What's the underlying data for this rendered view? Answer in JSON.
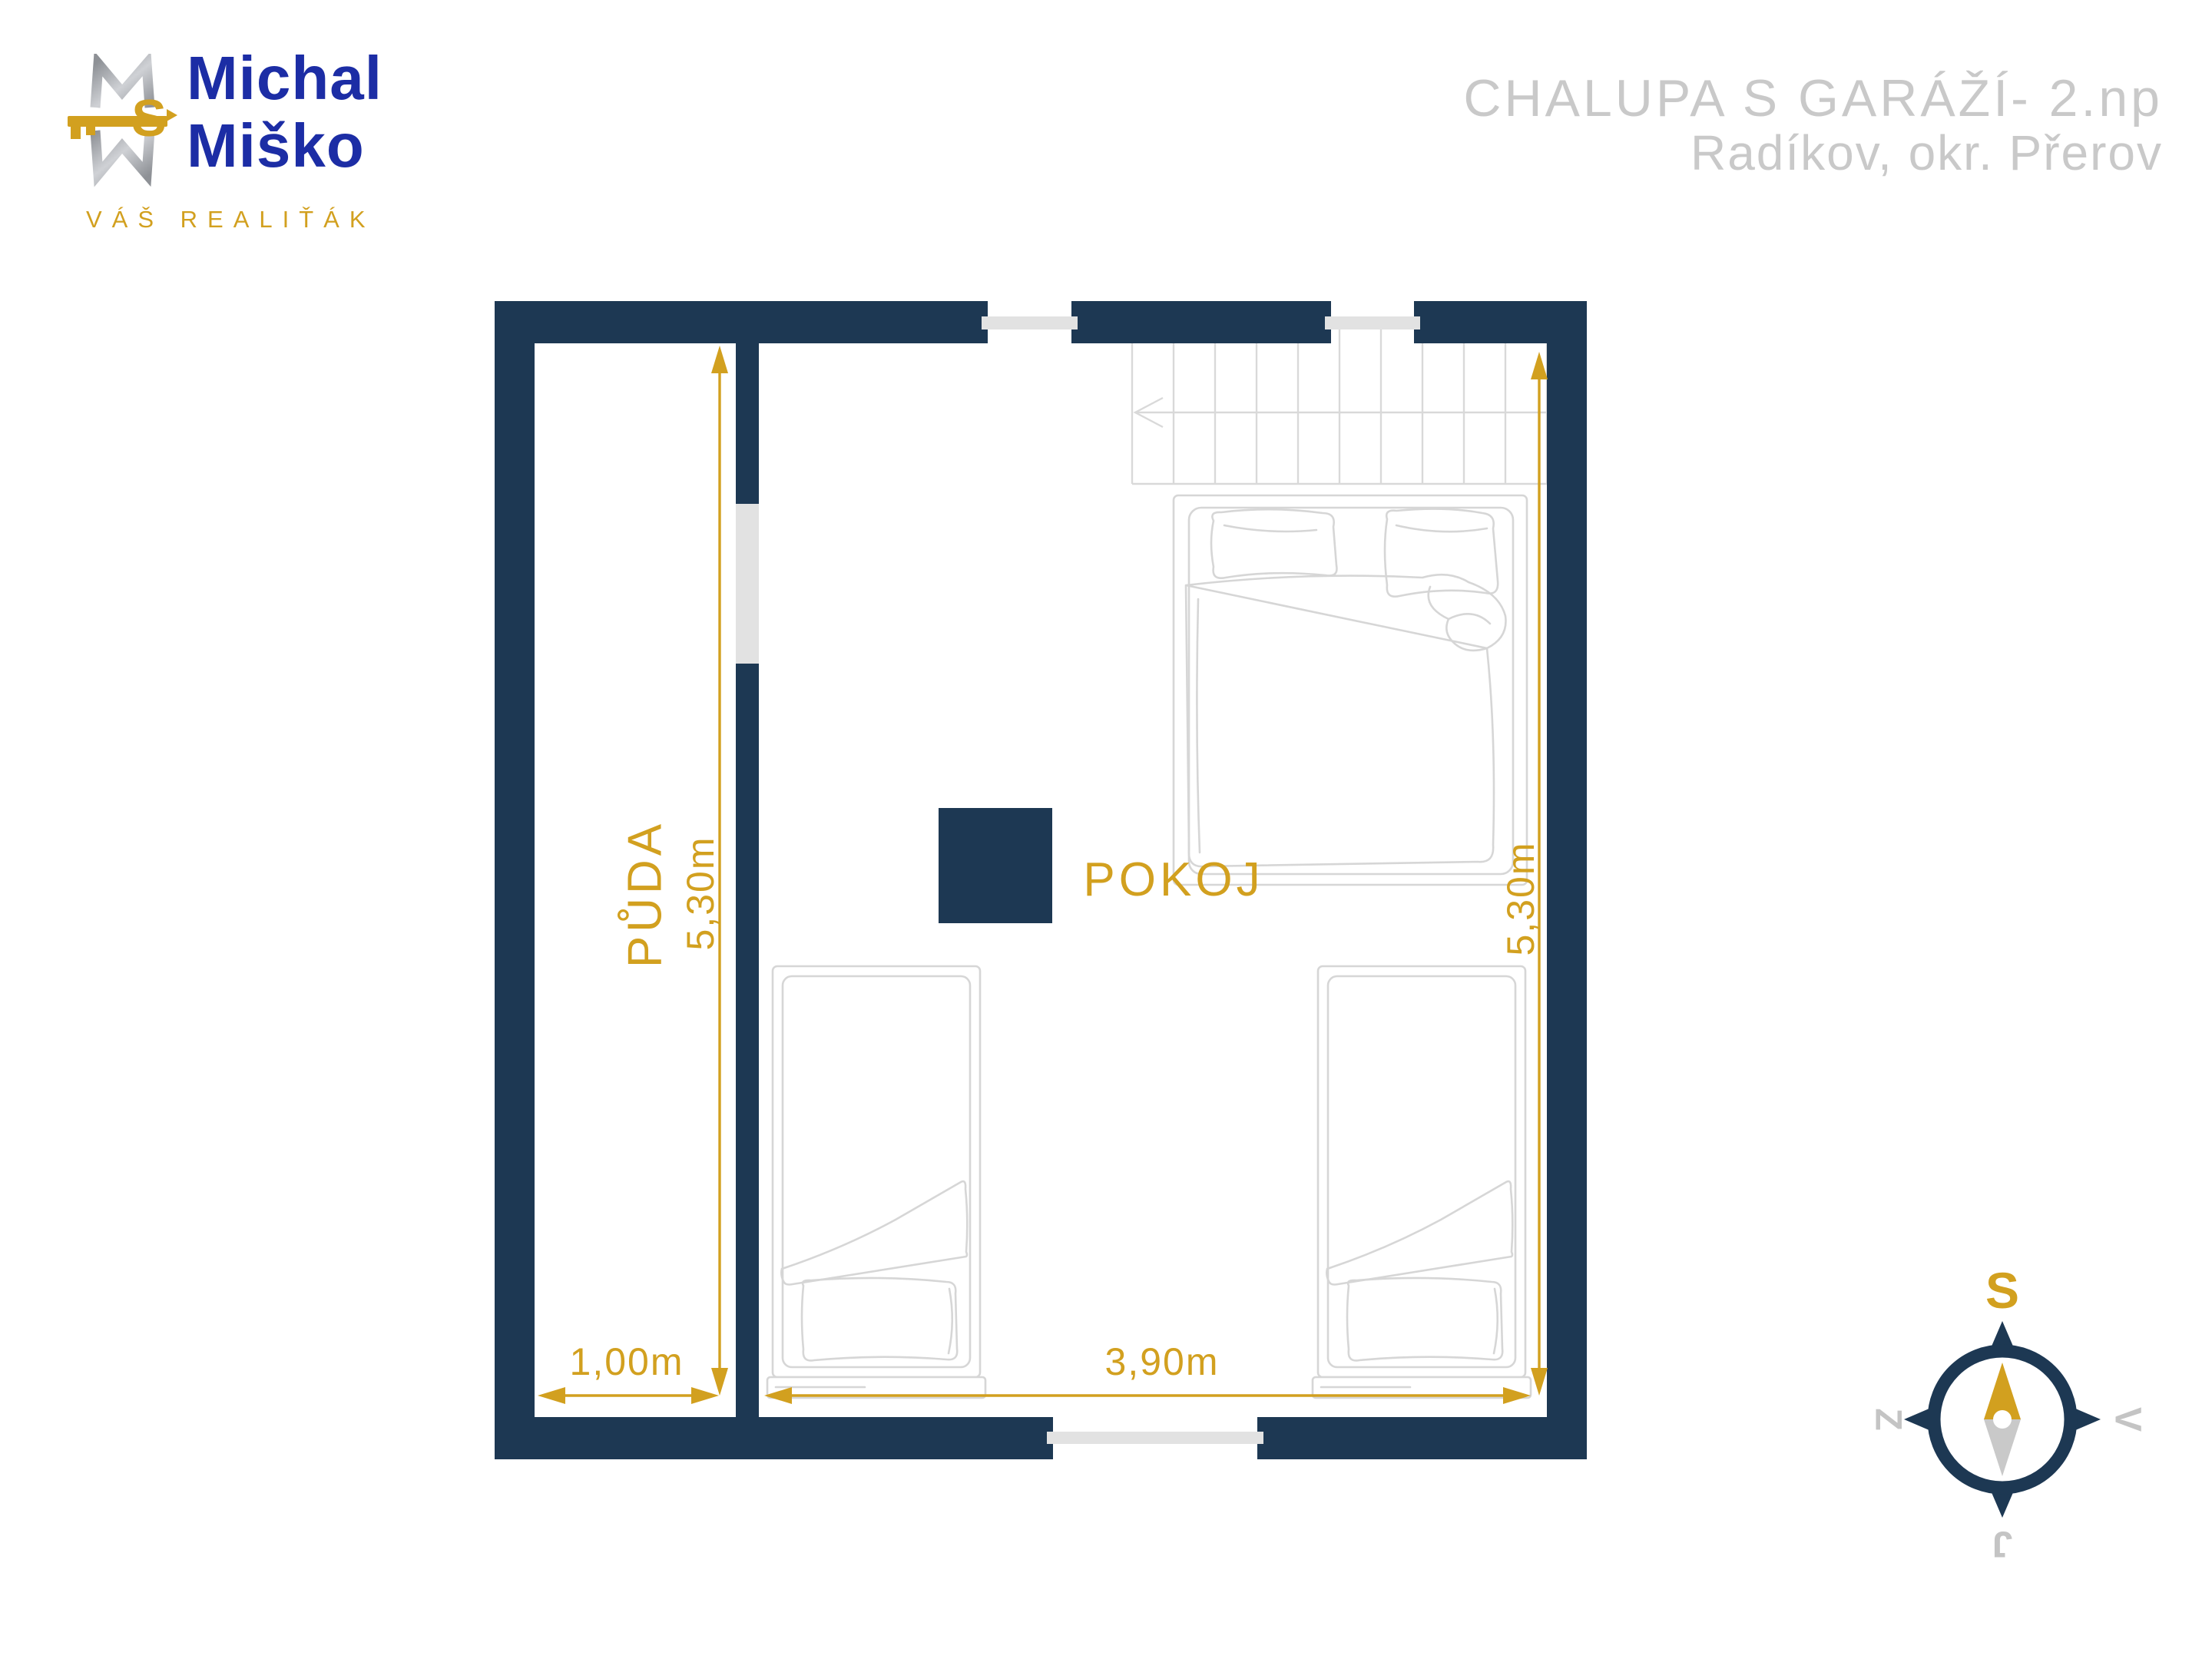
{
  "header": {
    "logo": {
      "name_line1": "Michal",
      "name_line2": "Miško",
      "tagline": "VÁŠ REALIŤÁK",
      "monogram_letter": "S"
    },
    "listing_title": "CHALUPA S GARÁŽÍ- 2.np",
    "listing_location": "Radíkov, okr. Přerov"
  },
  "floorplan": {
    "rooms": [
      {
        "label": "PŮDA",
        "width_label": "1,00m",
        "height_label": "5,30m"
      },
      {
        "label": "POKOJ",
        "width_label": "3,90m",
        "height_label": "5,30m"
      }
    ]
  },
  "compass": {
    "top": "S",
    "right": "V",
    "bottom": "J",
    "left": "Z"
  },
  "colors": {
    "wall_navy": "#1d3853",
    "accent_gold": "#d2a01f",
    "title_gray": "#c9c9c9",
    "furniture_line": "#d6d6d6",
    "window_gray": "#e2e2e2",
    "logo_blue": "#1c2da5",
    "logo_silver": "#a9abb0"
  }
}
